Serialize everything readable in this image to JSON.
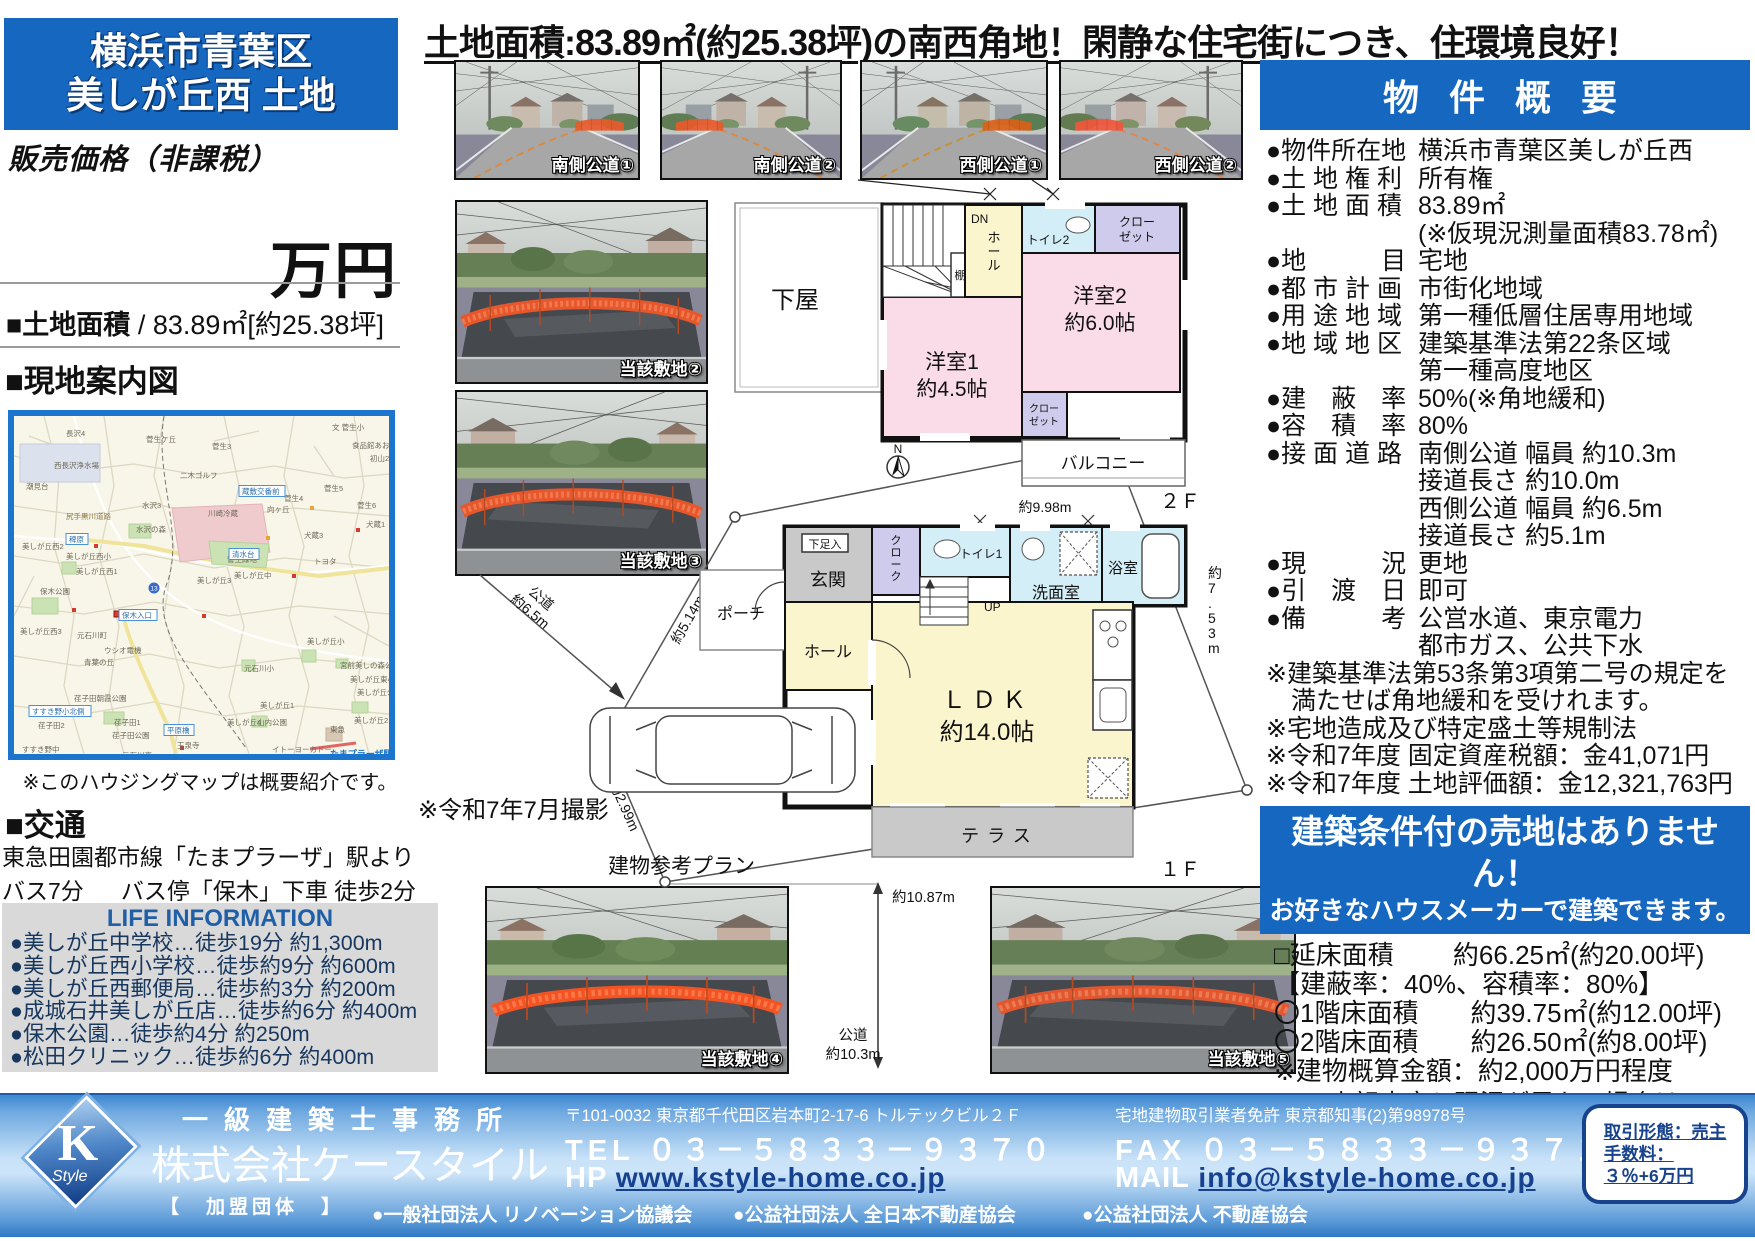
{
  "title_box": {
    "line1": "横浜市青葉区",
    "line2": "美しが丘西 土地"
  },
  "price": {
    "label": "販売価格（非課税）",
    "unit": "万円"
  },
  "land_area_line": {
    "label": "■土地面積",
    "value": " / 83.89㎡[約25.38坪]"
  },
  "headline": "土地面積:83.89㎡(約25.38坪)の南西角地！閑静な住宅街につき、住環境良好！",
  "map_section": {
    "heading": "■現地案内図",
    "note": "※このハウジングマップは概要紹介です。",
    "labels": [
      [
        "長沢4",
        52,
        20,
        ""
      ],
      [
        "菅生ケ丘",
        132,
        26,
        ""
      ],
      [
        "菅生3",
        198,
        33,
        ""
      ],
      [
        "文 菅生小",
        318,
        14,
        ""
      ],
      [
        "食品館あおば",
        338,
        32,
        ""
      ],
      [
        "初山2",
        356,
        45,
        ""
      ],
      [
        "西長沢浄水場",
        40,
        52,
        ""
      ],
      [
        "潮見台",
        12,
        73,
        ""
      ],
      [
        "水沢3",
        128,
        92,
        ""
      ],
      [
        "尻手黒川道路",
        52,
        103,
        "road"
      ],
      [
        "二木ゴルフ",
        166,
        62,
        ""
      ],
      [
        "向ヶ丘",
        253,
        96,
        ""
      ],
      [
        "菅生4",
        270,
        85,
        ""
      ],
      [
        "菅生5",
        310,
        75,
        ""
      ],
      [
        "菅生6",
        343,
        92,
        ""
      ],
      [
        "川崎冷蔵",
        194,
        100,
        ""
      ],
      [
        "水沢の森",
        122,
        116,
        ""
      ],
      [
        "菅生緑地",
        213,
        146,
        ""
      ],
      [
        "犬蔵3",
        290,
        122,
        ""
      ],
      [
        "犬蔵1",
        352,
        111,
        ""
      ],
      [
        "トヨタ",
        300,
        148,
        ""
      ],
      [
        "美しが丘西2",
        8,
        133,
        ""
      ],
      [
        "美しが丘西小",
        52,
        143,
        ""
      ],
      [
        "美しが丘西1",
        62,
        158,
        ""
      ],
      [
        "美しが丘3",
        183,
        167,
        ""
      ],
      [
        "美しが丘中",
        220,
        162,
        ""
      ],
      [
        "保木公園",
        26,
        178,
        ""
      ],
      [
        "美しが丘西3",
        6,
        218,
        ""
      ],
      [
        "元石川町",
        63,
        222,
        ""
      ],
      [
        "ウシオ電機",
        90,
        237,
        ""
      ],
      [
        "青葉の丘",
        70,
        249,
        ""
      ],
      [
        "元石川小",
        230,
        255,
        ""
      ],
      [
        "美しが丘小",
        293,
        228,
        ""
      ],
      [
        "宮前美しの森公園",
        326,
        252,
        ""
      ],
      [
        "美しが丘東小",
        336,
        266,
        ""
      ],
      [
        "美しが丘公園",
        343,
        279,
        ""
      ],
      [
        "荏子田朝霞公園",
        60,
        285,
        ""
      ],
      [
        "荏子田2",
        24,
        312,
        ""
      ],
      [
        "荏子田1",
        100,
        309,
        ""
      ],
      [
        "荏子田公園",
        98,
        322,
        ""
      ],
      [
        "玉泉寺",
        163,
        332,
        ""
      ],
      [
        "美しが丘1",
        246,
        292,
        ""
      ],
      [
        "山内公園",
        243,
        309,
        ""
      ],
      [
        "美しが丘4",
        213,
        309,
        ""
      ],
      [
        "美しが丘2",
        340,
        307,
        ""
      ],
      [
        "東急",
        316,
        316,
        ""
      ],
      [
        "イトーヨーカドー",
        258,
        336,
        ""
      ],
      [
        "すすき野中",
        8,
        336,
        ""
      ],
      [
        "元石川高",
        108,
        342,
        ""
      ],
      [
        "稗原",
        55,
        126,
        "box"
      ],
      [
        "清水台",
        218,
        141,
        "box"
      ],
      [
        "蔵敷交番前",
        228,
        78,
        "box"
      ],
      [
        "保木入口",
        108,
        202,
        "box"
      ],
      [
        "平原橋",
        153,
        317,
        "box"
      ],
      [
        "すすき野小北側",
        18,
        298,
        "box"
      ],
      [
        "たまプラーザ駅",
        316,
        341,
        "sta"
      ]
    ]
  },
  "shoot_note": "※令和7年7月撮影",
  "access": {
    "heading": "■交通",
    "line1": "東急田園都市線「たまプラーザ」駅よりバス7分",
    "line2": "バス停「保木」下車 徒歩2分"
  },
  "life_info": {
    "heading": "LIFE INFORMATION",
    "items": [
      "●美しが丘中学校…徒歩19分 約1,300m",
      "●美しが丘西小学校…徒歩約9分 約600m",
      "●美しが丘西郵便局…徒歩約3分 約200m",
      "●成城石井美しが丘店…徒歩約6分 約400m",
      "●保木公園…徒歩約4分 約250m",
      "●松田クリニック…徒歩約6分 約400m"
    ]
  },
  "photos": {
    "top": [
      {
        "caption": "南側公道①"
      },
      {
        "caption": "南側公道②"
      },
      {
        "caption": "西側公道①"
      },
      {
        "caption": "西側公道②"
      }
    ],
    "side": [
      {
        "caption": "当該敷地②"
      },
      {
        "caption": "当該敷地③"
      }
    ],
    "bottom": [
      {
        "caption": "当該敷地④"
      },
      {
        "caption": "当該敷地⑤"
      }
    ]
  },
  "floorplan": {
    "geya": "下屋",
    "dn": "DN",
    "hall2": "ホール",
    "shelf": "棚",
    "toilet2": "トイレ2",
    "closet_a1": "クロー",
    "closet_a2": "ゼット",
    "closet_b1": "クロー",
    "closet_b2": "ゼット",
    "room2": "洋室2",
    "room2size": "約6.0帖",
    "room1": "洋室1",
    "room1size": "約4.5帖",
    "balcony": "バルコニー",
    "f2": "２Ｆ",
    "north": "N",
    "dim998": "約9.98m",
    "shoe": "下足入",
    "genkan": "玄関",
    "cloak": "クローク",
    "toilet1": "トイレ1",
    "wash": "洗面室",
    "bath": "浴室",
    "porch": "ポーチ",
    "hall1": "ホール",
    "up": "UP",
    "ldk": "ＬＤＫ",
    "ldksize": "約14.0帖",
    "terrace": "テラス",
    "f1": "１Ｆ",
    "plan_note": "建物参考プラン",
    "dim_road65a": "公道",
    "dim_road65b": "約6.5m",
    "dim514": "約5.14m",
    "dim299": "約2.99m",
    "dim753": "約7.53m",
    "dim1087": "約10.87m",
    "road103a": "公道",
    "road103b": "約10.3m"
  },
  "overview": {
    "heading": "物 件 概 要",
    "rows": [
      {
        "label": "物件所在地",
        "lines": [
          "横浜市青葉区美しが丘西"
        ]
      },
      {
        "label": "土 地 権 利",
        "lines": [
          "所有権"
        ]
      },
      {
        "label": "土 地 面 積",
        "lines": [
          "83.89㎡",
          "(※仮現況測量面積83.78㎡)"
        ]
      },
      {
        "label": "地　　　目",
        "lines": [
          "宅地"
        ]
      },
      {
        "label": "都 市 計 画",
        "lines": [
          "市街化地域"
        ]
      },
      {
        "label": "用 途 地 域",
        "lines": [
          "第一種低層住居専用地域"
        ]
      },
      {
        "label": "地 域 地 区",
        "lines": [
          "建築基準法第22条区域",
          "第一種高度地区"
        ]
      },
      {
        "label": "建　蔽　率",
        "lines": [
          "50%(※角地緩和)"
        ]
      },
      {
        "label": "容　積　率",
        "lines": [
          "80%"
        ]
      },
      {
        "label": "接 面 道 路",
        "lines": [
          "南側公道 幅員 約10.3m",
          "接道長さ 約10.0m",
          "西側公道 幅員 約6.5m",
          "接道長さ 約5.1m"
        ]
      },
      {
        "label": "現　　　況",
        "lines": [
          "更地"
        ]
      },
      {
        "label": "引　渡　日",
        "lines": [
          "即可"
        ]
      },
      {
        "label": "備　　　考",
        "lines": [
          "公営水道、東京電力",
          "都市ガス、公共下水"
        ]
      }
    ],
    "notes": [
      "※建築基準法第53条第3項第二号の規定を",
      "　満たせば角地緩和を受けれます。",
      "※宅地造成及び特定盛土等規制法",
      "※令和7年度 固定資産税額：金41,071円",
      "※令和7年度 土地評価額：金12,321,763円"
    ],
    "banner": {
      "line1": "建築条件付の売地はありません！",
      "line2": "お好きなハウスメーカーで建築できます。"
    },
    "plan_details": [
      "□延床面積　　 約66.25㎡(約20.00坪)",
      "【建蔽率：40%、容積率：80%】",
      "〇1階床面積　　約39.75㎡(約12.00坪)",
      "〇2階床面積　　約26.50㎡(約8.00坪)",
      "※建物概算金額：約2,000万円程度"
    ],
    "disclaimer": [
      "＊上記内容と現況が異なる場合は、",
      "現況優先とさせていただきます。"
    ]
  },
  "footer": {
    "logo": {
      "k": "K",
      "style": "Style"
    },
    "office_type": "一級建築士事務所",
    "company": "株式会社ケースタイル",
    "member_label": "【　加盟団体　】",
    "address": "〒101-0032 東京都千代田区岩本町2-17-6 トルテックビル２Ｆ",
    "license": "宅地建物取引業者免許 東京都知事(2)第98978号",
    "tel_label": "TEL",
    "tel": "０３－５８３３－９３７０",
    "fax_label": "FAX",
    "fax": "０３－５８３３－９３７１",
    "hp_label": "HP",
    "hp": "www.kstyle-home.co.jp",
    "mail_label": "MAIL",
    "mail": "info@kstyle-home.co.jp",
    "orgs": [
      {
        "text": "●一般社団法人 リノベーション協議会",
        "x": 372
      },
      {
        "text": "●公益社団法人 全日本不動産協会",
        "x": 733
      },
      {
        "text": "●公益社団法人 不動産協会",
        "x": 1082
      }
    ],
    "deal_box": {
      "lines": [
        "取引形態：売主",
        "手数料：",
        "３％+6万円"
      ]
    }
  }
}
